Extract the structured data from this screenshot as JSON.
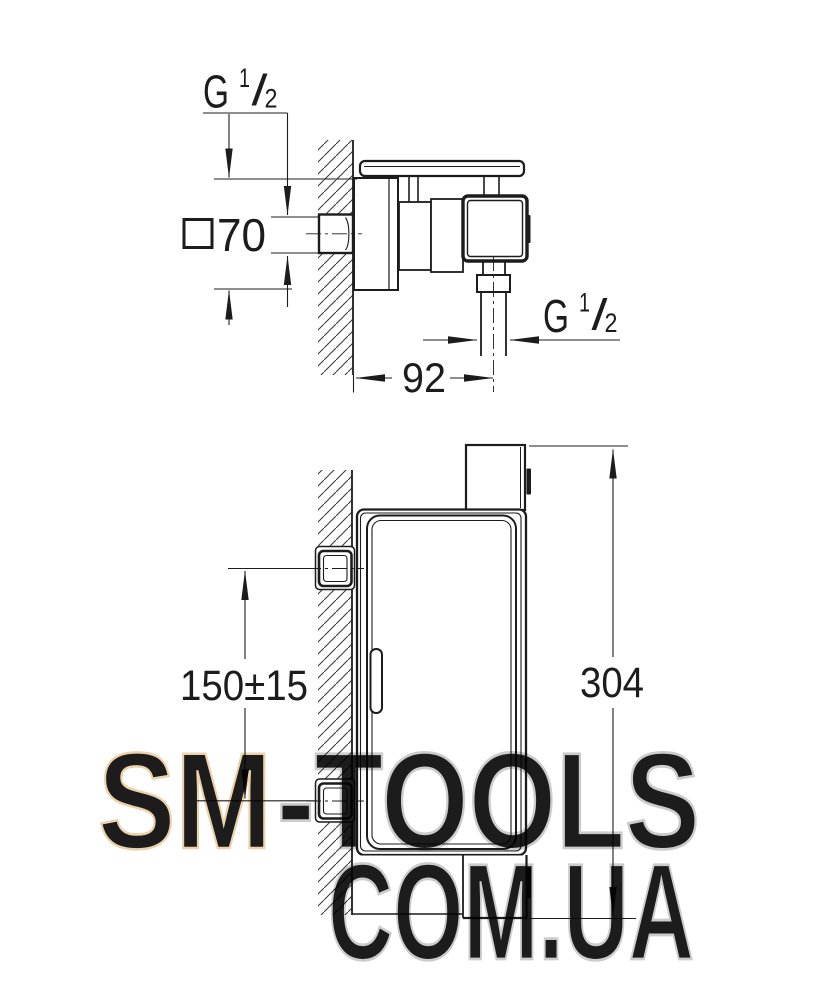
{
  "drawing": {
    "line_color": "#1c1c1c",
    "side_view": {
      "inlet_thread_label": {
        "g": "G",
        "sup": "1",
        "slash": "/",
        "sub": "2"
      },
      "outlet_thread_label": {
        "g": "G",
        "sup": "1",
        "slash": "/",
        "sub": "2"
      },
      "escutcheon_square_dim": "70",
      "wall_to_outlet_dim": "92"
    },
    "front_view": {
      "inlet_spacing_dim": "150±15",
      "overall_height_dim": "304"
    }
  },
  "watermark": {
    "part1": "SM",
    "part2": "-TOOLS",
    "part3": "COM.UA",
    "peach_fill": "#f8e5c9",
    "peach_stroke": "#edd1a8",
    "gray_stroke": "#cccccc"
  }
}
